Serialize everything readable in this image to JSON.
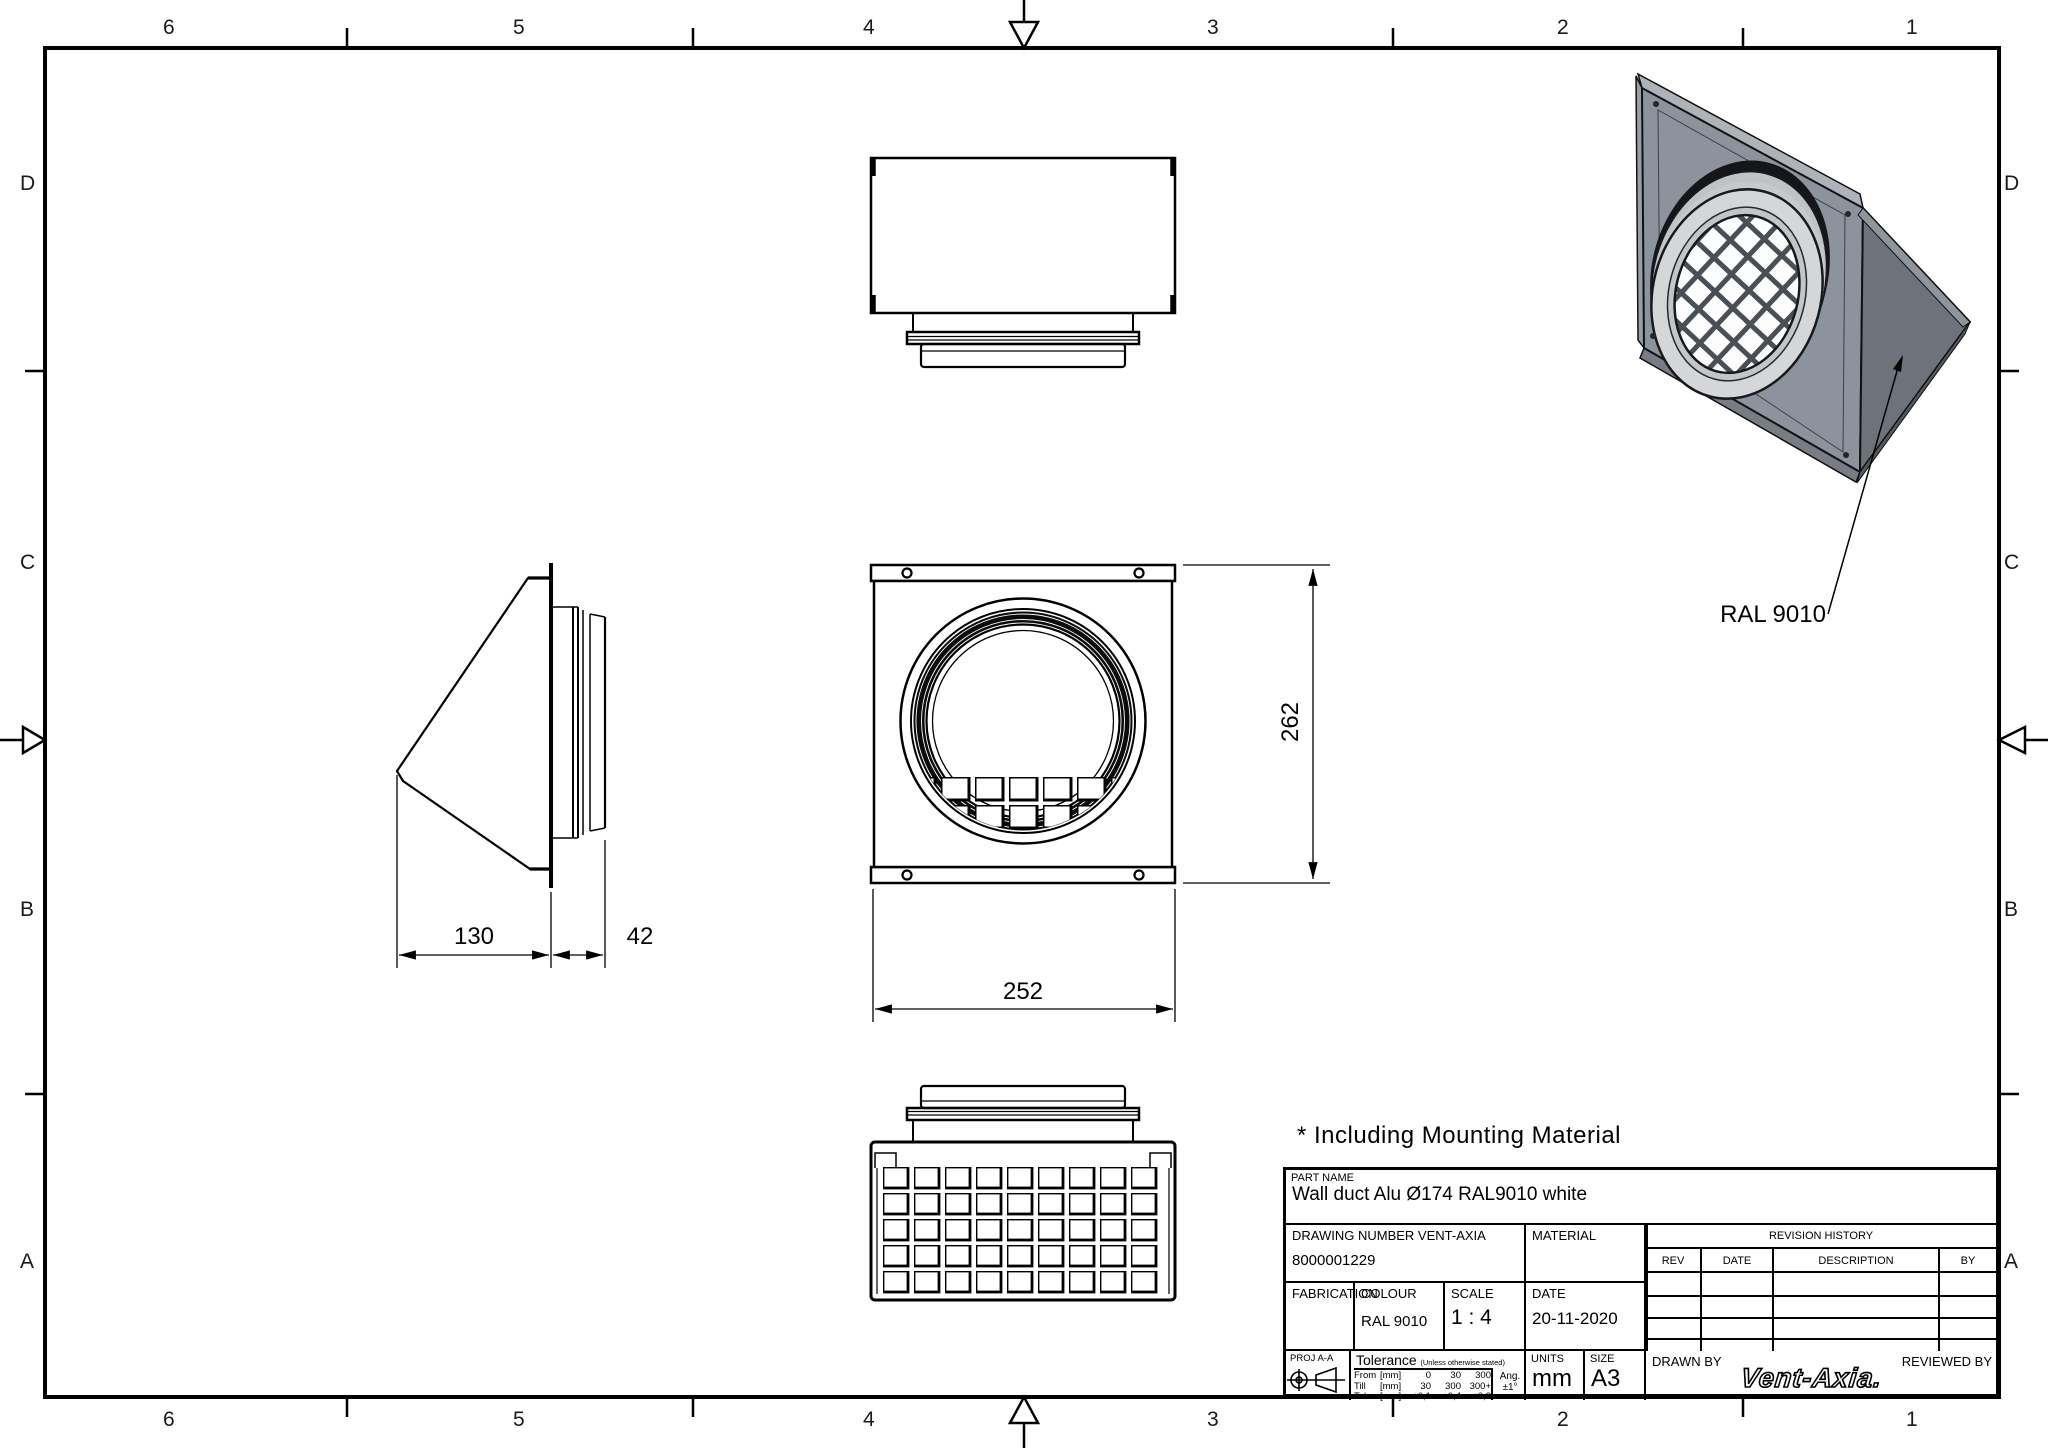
{
  "border": {
    "columns": [
      "6",
      "5",
      "4",
      "3",
      "2",
      "1"
    ],
    "rows": [
      "D",
      "C",
      "B",
      "A"
    ]
  },
  "annotations": {
    "mounting_note": "* Including Mounting Material",
    "color_callout": "RAL 9010"
  },
  "dimensions": {
    "front_width": "252",
    "front_height": "262",
    "hood_depth": "130",
    "spigot_depth": "42"
  },
  "title_block": {
    "part_name_label": "PART NAME",
    "part_name": "Wall duct Alu Ø174 RAL9010 white",
    "drawing_number_label": "DRAWING NUMBER VENT-AXIA",
    "drawing_number": "8000001229",
    "material_label": "MATERIAL",
    "material_value": "",
    "revision": {
      "title": "REVISION HISTORY",
      "headers": [
        "REV",
        "DATE",
        "DESCRIPTION",
        "BY"
      ]
    },
    "fabrication_label": "FABRICATION",
    "colour_label": "COLOUR",
    "colour_value": "RAL 9010",
    "scale_label": "SCALE",
    "scale_value": "1 : 4",
    "date_label": "DATE",
    "date_value": "20-11-2020",
    "projection_label": "PROJ A-A",
    "tolerance_label": "Tolerance",
    "tolerance_note": "(Unless otherwise stated)",
    "tolerance_rows": [
      [
        "From",
        "[mm]",
        "0",
        "30",
        "300"
      ],
      [
        "Till",
        "[mm]",
        "30",
        "300",
        "300+"
      ],
      [
        "Tol.",
        "[mm]",
        "±0,1",
        "±0,4",
        "±0,8"
      ]
    ],
    "angle_label": "Ang.",
    "angle_value": "±1°",
    "units_label": "UNITS",
    "units_value": "mm",
    "size_label": "SIZE",
    "size_value": "A3",
    "drawn_by_label": "DRAWN BY",
    "reviewed_by_label": "REVIEWED BY",
    "logo_text": "Vent-Axia."
  },
  "colors": {
    "line": "#000000",
    "iso_plate": "#8d939c",
    "iso_hood": "#6e737b",
    "iso_collar": "#d4d6d7",
    "iso_gasket": "#141619"
  }
}
